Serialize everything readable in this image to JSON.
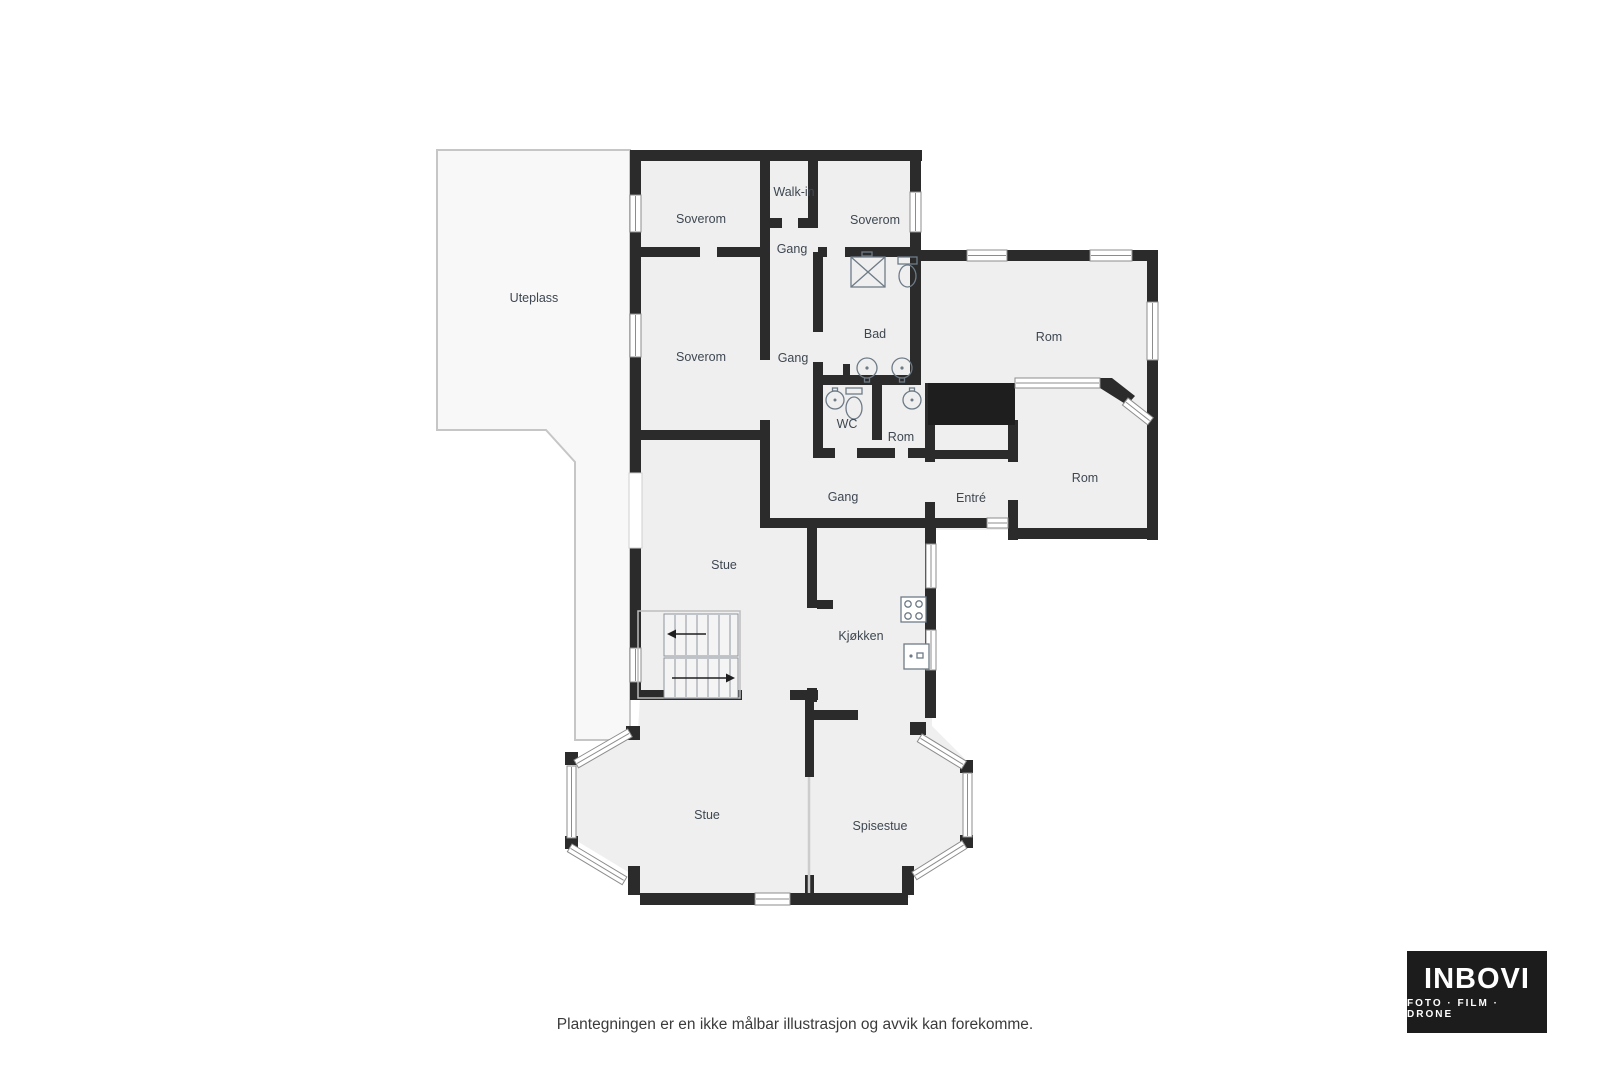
{
  "page": {
    "caption": "Plantegningen er en ikke målbar illustrasjon og avvik kan forekomme."
  },
  "logo": {
    "name": "INBOVI",
    "tagline": "FOTO · FILM · DRONE"
  },
  "colors": {
    "wall": "#2b2b2b",
    "room_fill": "#efefef",
    "outdoor_fill": "#f8f8f8",
    "bathroom_fill": "#abd2ee",
    "void_fill": "#1e1e1e",
    "label_text": "#3e4751",
    "logo_bg": "#1c1c1c"
  },
  "rooms": [
    {
      "label": "Uteplass"
    },
    {
      "label": "Soverom"
    },
    {
      "label": "Walk-in"
    },
    {
      "label": "Soverom"
    },
    {
      "label": "Gang"
    },
    {
      "label": "Soverom"
    },
    {
      "label": "Gang"
    },
    {
      "label": "Bad"
    },
    {
      "label": "Rom"
    },
    {
      "label": "WC"
    },
    {
      "label": "Rom"
    },
    {
      "label": "Gang"
    },
    {
      "label": "Entré"
    },
    {
      "label": "Rom"
    },
    {
      "label": "Stue"
    },
    {
      "label": "Kjøkken"
    },
    {
      "label": "Stue"
    },
    {
      "label": "Spisestue"
    }
  ]
}
